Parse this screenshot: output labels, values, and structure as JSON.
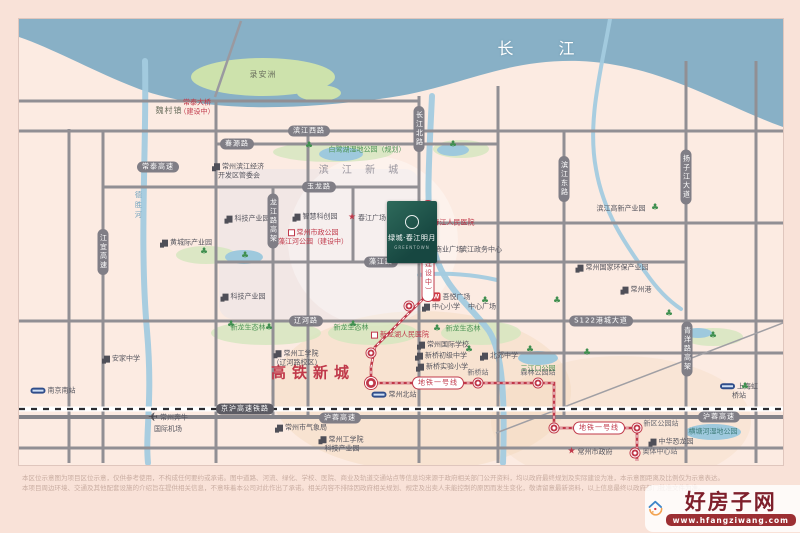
{
  "map": {
    "river_name": "长  江",
    "project": {
      "name": "绿城·春江明月",
      "sub": "GREENTOWN",
      "emblem": "ring-emblem"
    },
    "watermark": {
      "site_name": "好房子网",
      "url": "www.hfangziwang.com"
    },
    "disclaimer": {
      "line1": "本区位示意图为项目区位示意，仅供参考使用，不构成任何要约或承诺。图中道路、河流、绿化、学校、医院、商业及轨道交通站点等信息均来源于政府相关部门公开资料，均以政府最终规划及实际建设为准，本示意图距离及比例仅为示意表达。",
      "line2": "本项目周边环境、交通及其他配套设施的介绍旨在提供相关信息，不意味着本公司对此作出了承诺。相关内容不排除因政府相关规划、规定及出卖人未能控制的原因而发生变化，敬请留意最新资料，以上信息最终以政府部门批准文件为准。"
    },
    "labels": [
      {
        "n": "yangtze-river-label",
        "t": "长  江",
        "cls": "river-name",
        "x": 545,
        "y": 48
      },
      {
        "n": "luanzhou-island-label",
        "t": "录安洲",
        "cls": "land",
        "x": 262,
        "y": 74
      },
      {
        "n": "weicun-town-label",
        "t": "魏村镇",
        "cls": "land",
        "x": 168,
        "y": 110
      },
      {
        "n": "changtai-bridge-label",
        "t": "常泰大桥\n（建设中）",
        "cls": "red sm",
        "x": 196,
        "y": 106
      },
      {
        "n": "binjiang-newtown-label",
        "t": "滨 江 新 城",
        "cls": "area",
        "x": 360,
        "y": 170
      },
      {
        "n": "binjiang-hightech-park-label",
        "t": "滨江高新产业园",
        "cls": "dark",
        "x": 620,
        "y": 208
      },
      {
        "n": "hsr-newtown-label",
        "t": "高铁新城",
        "cls": "hsr",
        "x": 312,
        "y": 372
      },
      {
        "n": "binjiang-edz-label",
        "t": "常州滨江经济\n开发区管委会",
        "cls": "dark",
        "x": 238,
        "y": 170,
        "ic": "building"
      },
      {
        "n": "tech-park-1-label",
        "t": "科技产业园",
        "cls": "dark",
        "x": 247,
        "y": 218,
        "ic": "building"
      },
      {
        "n": "smart-innovation-park-label",
        "t": "智慧科创园",
        "cls": "dark",
        "x": 315,
        "y": 216,
        "ic": "building"
      },
      {
        "n": "tech-park-2-label",
        "t": "科技产业园",
        "cls": "dark",
        "x": 243,
        "y": 296,
        "ic": "building"
      },
      {
        "n": "huangchengji-park-label",
        "t": "黄城际产业园",
        "cls": "dark",
        "x": 186,
        "y": 242,
        "ic": "building"
      },
      {
        "n": "bailuhu-wetland-label",
        "t": "白鹭湖湿地公园（规划）",
        "cls": "green",
        "x": 366,
        "y": 149
      },
      {
        "n": "eco-forest-1-label",
        "t": "新龙生态林",
        "cls": "green",
        "x": 247,
        "y": 327
      },
      {
        "n": "eco-forest-2-label",
        "t": "新龙生态林",
        "cls": "green",
        "x": 350,
        "y": 327
      },
      {
        "n": "eco-forest-3-label",
        "t": "新龙生态林",
        "cls": "green",
        "x": 462,
        "y": 328
      },
      {
        "n": "sanjiangkou-park-label",
        "t": "三江口公园",
        "cls": "green",
        "x": 537,
        "y": 368
      },
      {
        "n": "hengtanghe-wetland-label",
        "t": "横塘河湿地公园",
        "cls": "teal",
        "x": 712,
        "y": 431
      },
      {
        "n": "chunjiang-hospital-label",
        "t": "春江人民医院",
        "cls": "red",
        "x": 448,
        "y": 222,
        "ic": "hospital"
      },
      {
        "n": "xinlonghu-hospital-label",
        "t": "新龙湖人民医院",
        "cls": "red",
        "x": 399,
        "y": 334,
        "ic": "hospital"
      },
      {
        "n": "zaojiang-river-park-label",
        "t": "常州市政公园\n藻江河公园（建设中）",
        "cls": "red",
        "x": 312,
        "y": 236,
        "ic": "hospital"
      },
      {
        "n": "binjiang-mall-label",
        "t": "滨江商业广场",
        "cls": "dark",
        "x": 441,
        "y": 249
      },
      {
        "n": "binjiang-admin-label",
        "t": "滨江政务中心",
        "cls": "dark",
        "x": 480,
        "y": 249
      },
      {
        "n": "chunjiang-square-label",
        "t": "春江广场",
        "cls": "dark",
        "x": 366,
        "y": 217,
        "ic": "star"
      },
      {
        "n": "intl-school-label",
        "t": "常州国际学校",
        "cls": "dark",
        "x": 443,
        "y": 344,
        "ic": "building"
      },
      {
        "n": "xinqiao-middle-label",
        "t": "新桥初级中学",
        "cls": "dark",
        "x": 441,
        "y": 355,
        "ic": "building"
      },
      {
        "n": "xinqiao-primary-label",
        "t": "新桥实验小学",
        "cls": "dark",
        "x": 442,
        "y": 366,
        "ic": "building"
      },
      {
        "n": "beijiao-middle-label",
        "t": "北郊中学",
        "cls": "dark",
        "x": 499,
        "y": 355,
        "ic": "building"
      },
      {
        "n": "wuyue-plaza-label",
        "t": "吾悦广场",
        "cls": "dark",
        "x": 450,
        "y": 296,
        "ic": "w"
      },
      {
        "n": "center-primary-label",
        "t": "中心小学",
        "cls": "dark",
        "x": 441,
        "y": 306,
        "ic": "building"
      },
      {
        "n": "center-square-label",
        "t": "中心广场",
        "cls": "dark",
        "x": 481,
        "y": 306
      },
      {
        "n": "cit-liaohe-label",
        "t": "常州工学院\n（辽河路校区）",
        "cls": "dark",
        "x": 296,
        "y": 357,
        "ic": "building"
      },
      {
        "n": "anjia-middle-label",
        "t": "安家中学",
        "cls": "dark",
        "x": 121,
        "y": 358,
        "ic": "building"
      },
      {
        "n": "weather-bureau-label",
        "t": "常州市气象局",
        "cls": "dark",
        "x": 301,
        "y": 427,
        "ic": "building"
      },
      {
        "n": "cit-tech-park-label",
        "t": "常州工学院\n科技产业园",
        "cls": "dark",
        "x": 341,
        "y": 443,
        "ic": "building"
      },
      {
        "n": "city-government-label",
        "t": "常州市政府",
        "cls": "dark",
        "x": 589,
        "y": 451,
        "ic": "star"
      },
      {
        "n": "dinosaur-park-label",
        "t": "中华恐龙园",
        "cls": "dark",
        "x": 671,
        "y": 441,
        "ic": "building"
      },
      {
        "n": "env-protection-park-label",
        "t": "常州国家环保产业园",
        "cls": "dark",
        "x": 612,
        "y": 267,
        "ic": "building"
      },
      {
        "n": "changzhou-port-label",
        "t": "常州港",
        "cls": "dark",
        "x": 636,
        "y": 289,
        "ic": "building"
      },
      {
        "n": "nanjing-south-station-label",
        "t": "南京南站",
        "cls": "dark",
        "x": 52,
        "y": 390,
        "ic": "train"
      },
      {
        "n": "hongqiao-station-label",
        "t": "上海虹桥站",
        "cls": "dark",
        "x": 738,
        "y": 390,
        "ic": "train"
      },
      {
        "n": "benniu-airport-label",
        "t": "常州奔牛\n国际机场",
        "cls": "dark",
        "x": 167,
        "y": 421,
        "ic": "plane"
      },
      {
        "n": "changzhou-north-station-label",
        "t": "常州北站",
        "cls": "dark",
        "x": 393,
        "y": 394,
        "ic": "train"
      },
      {
        "n": "chunjiang-station-label",
        "t": "春江站",
        "cls": "sta",
        "x": 403,
        "y": 231
      },
      {
        "n": "xinqiao-station-label",
        "t": "新桥站",
        "cls": "sta",
        "x": 477,
        "y": 372
      },
      {
        "n": "forest-park-station-label",
        "t": "森林公园站",
        "cls": "sta",
        "x": 537,
        "y": 372
      },
      {
        "n": "xinqu-park-station-label",
        "t": "新区公园站",
        "cls": "sta",
        "x": 660,
        "y": 423
      },
      {
        "n": "aoti-center-station-label",
        "t": "奥体中心站",
        "cls": "sta",
        "x": 659,
        "y": 451
      },
      {
        "n": "desheng-river-label",
        "t": "德胜河",
        "cls": "water-v",
        "x": 137,
        "y": 205
      }
    ],
    "road_pills": [
      {
        "n": "binjiang-west-rd-pill",
        "t": "滨江西路",
        "x": 308,
        "y": 130,
        "o": "h"
      },
      {
        "n": "chunyuan-rd-pill",
        "t": "春源路",
        "x": 236,
        "y": 143,
        "o": "h"
      },
      {
        "n": "changtai-expwy-pill",
        "t": "常泰高速",
        "x": 157,
        "y": 166,
        "o": "h"
      },
      {
        "n": "yulong-rd-pill",
        "t": "玉龙路",
        "x": 318,
        "y": 186,
        "o": "h"
      },
      {
        "n": "zaojiang-rd-pill",
        "t": "藻江路",
        "x": 380,
        "y": 261,
        "o": "h"
      },
      {
        "n": "liaohe-rd-pill",
        "t": "辽河路",
        "x": 305,
        "y": 320,
        "o": "h"
      },
      {
        "n": "s122-gangcheng-ave-pill",
        "t": "S122港城大道",
        "x": 600,
        "y": 320,
        "o": "h"
      },
      {
        "n": "jinghu-hsr-pill",
        "t": "京沪高速铁路",
        "x": 244,
        "y": 408,
        "o": "h",
        "cls": "dark"
      },
      {
        "n": "hurong-expwy-pill-1",
        "t": "沪蓉高速",
        "x": 339,
        "y": 417,
        "o": "h"
      },
      {
        "n": "hurong-expwy-pill-2",
        "t": "沪蓉高速",
        "x": 718,
        "y": 416,
        "o": "h"
      },
      {
        "n": "jiangyi-expwy-pill",
        "t": "江宜高速",
        "x": 102,
        "y": 251,
        "o": "v"
      },
      {
        "n": "changjiang-north-rd-pill",
        "t": "长江北路",
        "x": 418,
        "y": 128,
        "o": "v"
      },
      {
        "n": "binjiang-east-rd-pill",
        "t": "滨江东路",
        "x": 563,
        "y": 178,
        "o": "v"
      },
      {
        "n": "yangzijiang-ave-pill",
        "t": "扬子江大道",
        "x": 685,
        "y": 176,
        "o": "v"
      },
      {
        "n": "qingyang-viaduct-pill",
        "t": "青洋路高架",
        "x": 686,
        "y": 348,
        "o": "v"
      },
      {
        "n": "longjiang-viaduct-pill",
        "t": "龙江路高架",
        "x": 272,
        "y": 220,
        "o": "v"
      },
      {
        "n": "metro-line1-pill-1",
        "t": "地铁一号线",
        "x": 437,
        "y": 382,
        "o": "h",
        "cls": "red"
      },
      {
        "n": "metro-line1-pill-2",
        "t": "地铁一号线",
        "x": 598,
        "y": 427,
        "o": "h",
        "cls": "red"
      },
      {
        "n": "metro-line1-pill-v",
        "t": "地铁一号线（建设中）",
        "x": 427,
        "y": 250,
        "o": "v",
        "cls": "red"
      }
    ],
    "metro": {
      "color": "#c0394a",
      "line_points": "422,222 422,298 408,312 374,346 370,366 370,382 553,382 553,427 636,427 636,460",
      "stations": [
        [
          422,
          227
        ],
        [
          408,
          305
        ],
        [
          370,
          352
        ],
        [
          370,
          382,
          1
        ],
        [
          477,
          382
        ],
        [
          537,
          382
        ],
        [
          553,
          427
        ],
        [
          636,
          427
        ],
        [
          634,
          452
        ]
      ]
    },
    "trees": [
      [
        308,
        145
      ],
      [
        452,
        144
      ],
      [
        203,
        251
      ],
      [
        244,
        255
      ],
      [
        230,
        324
      ],
      [
        268,
        327
      ],
      [
        352,
        324
      ],
      [
        436,
        328
      ],
      [
        468,
        349
      ],
      [
        529,
        349
      ],
      [
        654,
        207
      ],
      [
        712,
        335
      ],
      [
        744,
        386
      ],
      [
        556,
        300
      ],
      [
        668,
        313
      ],
      [
        484,
        300
      ],
      [
        586,
        352
      ]
    ],
    "geo": {
      "land_color": "#fcebe2",
      "river_color": "#88b0c6",
      "island_color": "#cde2ac",
      "stream_color": "#a3cbdf",
      "road_color": "#918f94",
      "railway_color": "#2c2c30",
      "river_path": "M0,0 L764,0 L764,108 C700,85 640,45 560,42 C480,40 440,70 360,80 C280,90 190,95 120,70 C80,55 35,30 0,18 Z",
      "island": [
        244,
        58,
        72,
        19
      ],
      "island2": [
        300,
        74,
        22,
        8
      ],
      "bridge": [
        222,
        2,
        196,
        78
      ],
      "roads_v": [
        [
          50,
          110,
          50,
          444
        ],
        [
          84,
          112,
          84,
          444
        ],
        [
          197,
          82,
          197,
          444
        ],
        [
          254,
          168,
          254,
          398
        ],
        [
          289,
          112,
          289,
          398
        ],
        [
          334,
          168,
          334,
          243
        ],
        [
          400,
          77,
          400,
          444
        ],
        [
          479,
          67,
          479,
          444
        ],
        [
          545,
          112,
          545,
          398
        ],
        [
          667,
          42,
          667,
          444
        ],
        [
          737,
          42,
          737,
          444
        ]
      ],
      "roads_h": [
        [
          0,
          82,
          400,
          82
        ],
        [
          0,
          112,
          764,
          112
        ],
        [
          197,
          125,
          479,
          125
        ],
        [
          84,
          168,
          400,
          168
        ],
        [
          400,
          204,
          764,
          204
        ],
        [
          197,
          243,
          667,
          243
        ],
        [
          0,
          302,
          764,
          302
        ],
        [
          479,
          334,
          764,
          334
        ],
        [
          0,
          429,
          764,
          429
        ]
      ],
      "railway_y": 390,
      "highway_y": 398,
      "diag_rail": [
        477,
        414,
        764,
        304
      ],
      "streams": [
        "M126,42 C128,122 120,222 128,312 C134,382 126,412 129,444",
        "M413,77 C410,142 406,192 415,230 C423,268 452,287 470,312 C484,334 486,382 484,444",
        "M591,0 C582,52 568,102 577,150 C585,197 610,230 627,254 C638,270 650,282 662,290",
        "M400,256 C427,253 457,256 478,261"
      ],
      "lakes": [
        [
          322,
          135,
          22,
          7
        ],
        [
          434,
          131,
          16,
          6
        ],
        [
          225,
          238,
          19,
          7
        ],
        [
          519,
          339,
          20,
          7
        ],
        [
          694,
          413,
          28,
          8
        ],
        [
          679,
          314,
          14,
          5
        ]
      ],
      "green_patches": [
        [
          247,
          314,
          55,
          12
        ],
        [
          354,
          314,
          45,
          12
        ],
        [
          462,
          314,
          40,
          12
        ],
        [
          314,
          133,
          60,
          10
        ],
        [
          442,
          130,
          28,
          9
        ],
        [
          187,
          236,
          30,
          9
        ],
        [
          694,
          318,
          30,
          9
        ]
      ],
      "zones": [
        {
          "type": "rect",
          "v": [
            200,
            150,
            200,
            150
          ],
          "fill": "#e8e3e8",
          "op": 0.5
        },
        {
          "type": "ellipse",
          "v": [
            402,
            372,
            150,
            80
          ],
          "fill": "#f3d6b8",
          "op": 0.4
        },
        {
          "type": "ellipse",
          "v": [
            602,
            402,
            130,
            65
          ],
          "fill": "#f3d6b8",
          "op": 0.3
        },
        {
          "type": "circle",
          "v": [
            354,
            222,
            85
          ],
          "fill": "#ffffff",
          "op": 0.35
        }
      ]
    }
  }
}
